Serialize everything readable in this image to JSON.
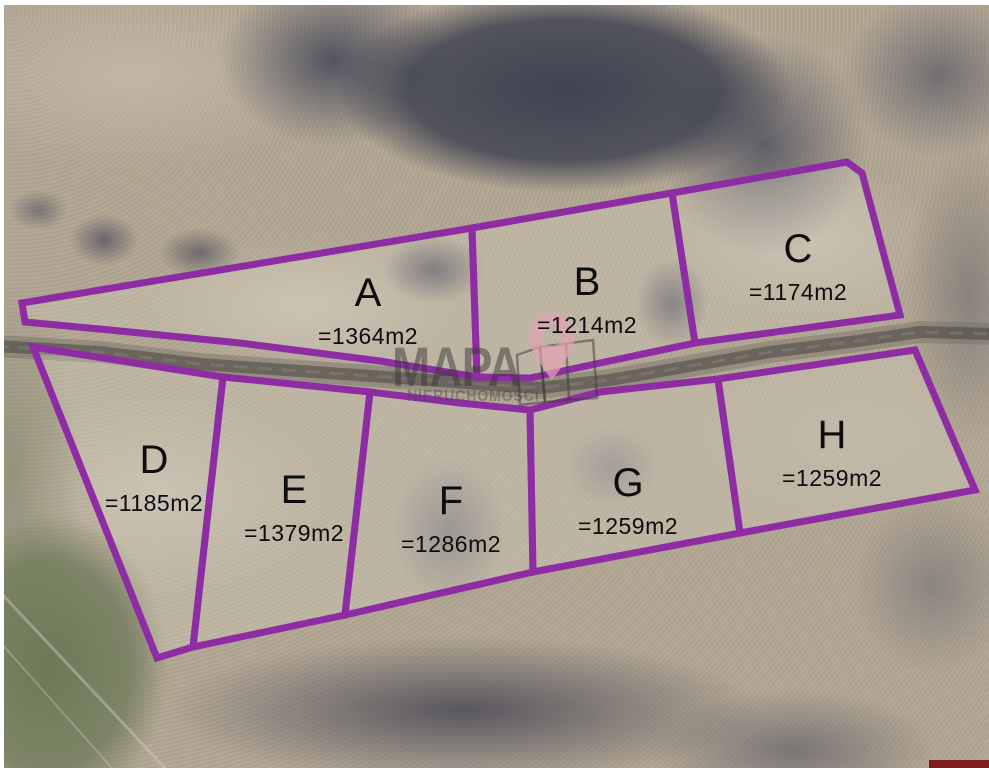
{
  "map": {
    "watermark": {
      "title": "MAPA",
      "subtitle": "NIERUCHOMOŚCI"
    },
    "plots": [
      {
        "id": "A",
        "label": "A",
        "area": "=1364m2"
      },
      {
        "id": "B",
        "label": "B",
        "area": "=1214m2"
      },
      {
        "id": "C",
        "label": "C",
        "area": "=1174m2"
      },
      {
        "id": "D",
        "label": "D",
        "area": "=1185m2"
      },
      {
        "id": "E",
        "label": "E",
        "area": "=1379m2"
      },
      {
        "id": "F",
        "label": "F",
        "area": "=1286m2"
      },
      {
        "id": "G",
        "label": "G",
        "area": "=1259m2"
      },
      {
        "id": "H",
        "label": "H",
        "area": "=1259m2"
      }
    ],
    "colors": {
      "plot_outline": "#8e2da3",
      "label_text": "#0d0d0d",
      "watermark_gray": "#3c373a",
      "watermark_pin_pink": "#e2a2b6",
      "border_white": "#ffffff",
      "corner_bar_red": "#7e1f1f"
    }
  }
}
